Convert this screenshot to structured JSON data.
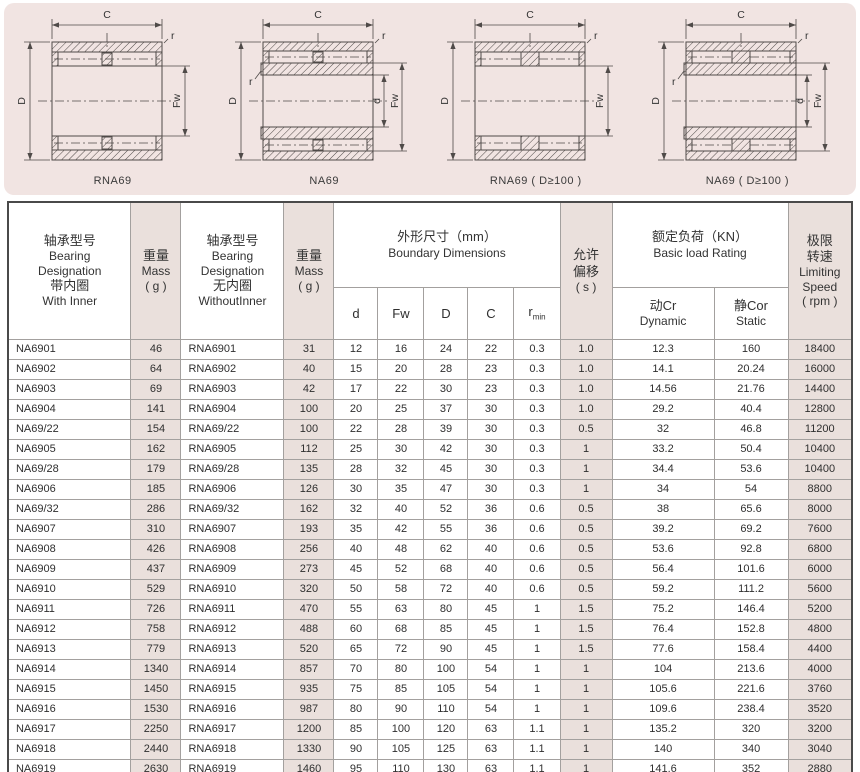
{
  "drawings": {
    "panel_bg": "#f1e4e2",
    "items": [
      {
        "caption": "RNA69",
        "labels": {
          "C": "C",
          "D": "D",
          "Fw": "Fw",
          "r": "r"
        }
      },
      {
        "caption": "NA69",
        "labels": {
          "C": "C",
          "D": "D",
          "Fw": "Fw",
          "d": "d",
          "r": "r",
          "r2": "r"
        }
      },
      {
        "caption": "RNA69 ( D≥100 )",
        "labels": {
          "C": "C",
          "D": "D",
          "Fw": "Fw",
          "r": "r"
        }
      },
      {
        "caption": "NA69 ( D≥100 )",
        "labels": {
          "C": "C",
          "D": "D",
          "Fw": "Fw",
          "d": "d",
          "r": "r",
          "r2": "r"
        }
      }
    ]
  },
  "table": {
    "shade_color": "#eae0dc",
    "border_color": "#4a4a4a",
    "columns": {
      "with_inner": {
        "cn": "轴承型号",
        "en1": "Bearing",
        "en2": "Designation",
        "cn2": "带内圈",
        "en3": "With Inner"
      },
      "mass1": {
        "cn": "重量",
        "en": "Mass",
        "unit": "( g )"
      },
      "without_inner": {
        "cn": "轴承型号",
        "en1": "Bearing",
        "en2": "Designation",
        "cn2": "无内圈",
        "en3": "WithoutInner"
      },
      "mass2": {
        "cn": "重量",
        "en": "Mass",
        "unit": "( g )"
      },
      "boundary": {
        "cn": "外形尺寸（mm）",
        "en": "Boundary Dimensions"
      },
      "d": "d",
      "fw": "Fw",
      "D": "D",
      "C": "C",
      "rmin_base": "r",
      "rmin_sub": "min",
      "offset": {
        "cn1": "允许",
        "cn2": "偏移",
        "unit": "( s )"
      },
      "load": {
        "cn": "额定负荷（KN）",
        "en": "Basic load Rating"
      },
      "dynamic": {
        "cn": "动Cr",
        "en": "Dynamic"
      },
      "static": {
        "cn": "静Cor",
        "en": "Static"
      },
      "speed": {
        "cn1": "极限",
        "cn2": "转速",
        "en1": "Limiting",
        "en2": "Speed",
        "unit": "( rpm )"
      }
    },
    "rows": [
      [
        "NA6901",
        "46",
        "RNA6901",
        "31",
        "12",
        "16",
        "24",
        "22",
        "0.3",
        "1.0",
        "12.3",
        "160",
        "18400"
      ],
      [
        "NA6902",
        "64",
        "RNA6902",
        "40",
        "15",
        "20",
        "28",
        "23",
        "0.3",
        "1.0",
        "14.1",
        "20.24",
        "16000"
      ],
      [
        "NA6903",
        "69",
        "RNA6903",
        "42",
        "17",
        "22",
        "30",
        "23",
        "0.3",
        "1.0",
        "14.56",
        "21.76",
        "14400"
      ],
      [
        "NA6904",
        "141",
        "RNA6904",
        "100",
        "20",
        "25",
        "37",
        "30",
        "0.3",
        "1.0",
        "29.2",
        "40.4",
        "12800"
      ],
      [
        "NA69/22",
        "154",
        "RNA69/22",
        "100",
        "22",
        "28",
        "39",
        "30",
        "0.3",
        "0.5",
        "32",
        "46.8",
        "11200"
      ],
      [
        "NA6905",
        "162",
        "RNA6905",
        "112",
        "25",
        "30",
        "42",
        "30",
        "0.3",
        "1",
        "33.2",
        "50.4",
        "10400"
      ],
      [
        "NA69/28",
        "179",
        "RNA69/28",
        "135",
        "28",
        "32",
        "45",
        "30",
        "0.3",
        "1",
        "34.4",
        "53.6",
        "10400"
      ],
      [
        "NA6906",
        "185",
        "RNA6906",
        "126",
        "30",
        "35",
        "47",
        "30",
        "0.3",
        "1",
        "34",
        "54",
        "8800"
      ],
      [
        "NA69/32",
        "286",
        "RNA69/32",
        "162",
        "32",
        "40",
        "52",
        "36",
        "0.6",
        "0.5",
        "38",
        "65.6",
        "8000"
      ],
      [
        "NA6907",
        "310",
        "RNA6907",
        "193",
        "35",
        "42",
        "55",
        "36",
        "0.6",
        "0.5",
        "39.2",
        "69.2",
        "7600"
      ],
      [
        "NA6908",
        "426",
        "RNA6908",
        "256",
        "40",
        "48",
        "62",
        "40",
        "0.6",
        "0.5",
        "53.6",
        "92.8",
        "6800"
      ],
      [
        "NA6909",
        "437",
        "RNA6909",
        "273",
        "45",
        "52",
        "68",
        "40",
        "0.6",
        "0.5",
        "56.4",
        "101.6",
        "6000"
      ],
      [
        "NA6910",
        "529",
        "RNA6910",
        "320",
        "50",
        "58",
        "72",
        "40",
        "0.6",
        "0.5",
        "59.2",
        "111.2",
        "5600"
      ],
      [
        "NA6911",
        "726",
        "RNA6911",
        "470",
        "55",
        "63",
        "80",
        "45",
        "1",
        "1.5",
        "75.2",
        "146.4",
        "5200"
      ],
      [
        "NA6912",
        "758",
        "RNA6912",
        "488",
        "60",
        "68",
        "85",
        "45",
        "1",
        "1.5",
        "76.4",
        "152.8",
        "4800"
      ],
      [
        "NA6913",
        "779",
        "RNA6913",
        "520",
        "65",
        "72",
        "90",
        "45",
        "1",
        "1.5",
        "77.6",
        "158.4",
        "4400"
      ],
      [
        "NA6914",
        "1340",
        "RNA6914",
        "857",
        "70",
        "80",
        "100",
        "54",
        "1",
        "1",
        "104",
        "213.6",
        "4000"
      ],
      [
        "NA6915",
        "1450",
        "RNA6915",
        "935",
        "75",
        "85",
        "105",
        "54",
        "1",
        "1",
        "105.6",
        "221.6",
        "3760"
      ],
      [
        "NA6916",
        "1530",
        "RNA6916",
        "987",
        "80",
        "90",
        "110",
        "54",
        "1",
        "1",
        "109.6",
        "238.4",
        "3520"
      ],
      [
        "NA6917",
        "2250",
        "RNA6917",
        "1200",
        "85",
        "100",
        "120",
        "63",
        "1.1",
        "1",
        "135.2",
        "320",
        "3200"
      ],
      [
        "NA6918",
        "2440",
        "RNA6918",
        "1330",
        "90",
        "105",
        "125",
        "63",
        "1.1",
        "1",
        "140",
        "340",
        "3040"
      ],
      [
        "NA6919",
        "2630",
        "RNA6919",
        "1460",
        "95",
        "110",
        "130",
        "63",
        "1.1",
        "1",
        "141.6",
        "352",
        "2880"
      ]
    ]
  }
}
